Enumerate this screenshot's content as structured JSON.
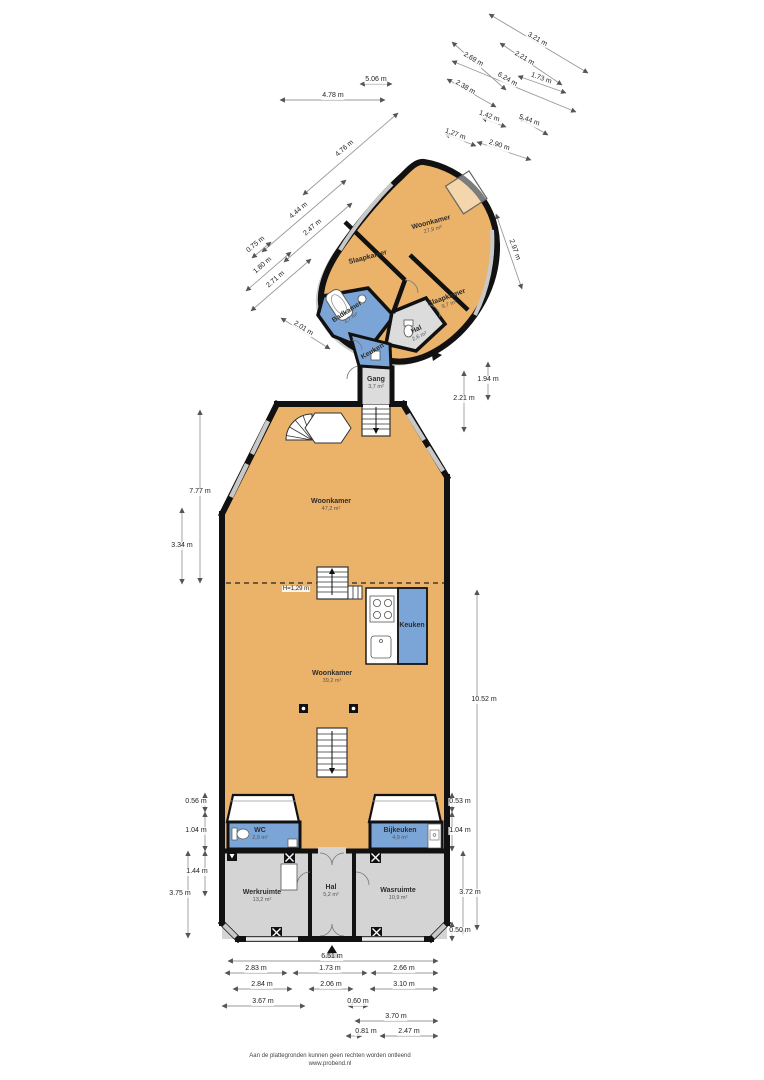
{
  "title": "Floor plan",
  "colors": {
    "room_orange": "#EBB269",
    "room_blue": "#7BA5D6",
    "room_gray": "#D4D4D4",
    "wall_black": "#111111",
    "dimension_gray": "#9A9A9A"
  },
  "top_building": {
    "rooms": {
      "woonkamer": {
        "name": "Woonkamer",
        "area": "27,9 m²"
      },
      "slaapkamer_left": {
        "name": "Slaapkamer"
      },
      "slaapkamer_right": {
        "name": "Slaapkamer",
        "area": "9,7 m²"
      },
      "badkamer": {
        "name": "Badkamer",
        "area": "3,7 m²"
      },
      "hal": {
        "name": "Hal",
        "area": "2,6 m²"
      },
      "keuken": {
        "name": "Keuken"
      }
    }
  },
  "connector": {
    "gang": {
      "name": "Gang",
      "area": "3,7 m²"
    }
  },
  "main_building": {
    "rooms": {
      "woonkamer_top": {
        "name": "Woonkamer",
        "area": "47,2 m²"
      },
      "woonkamer_mid": {
        "name": "Woonkamer",
        "area": "39,2 m²"
      },
      "keuken": {
        "name": "Keuken"
      },
      "wc": {
        "name": "WC",
        "area": "2,9 m²"
      },
      "bijkeuken": {
        "name": "Bijkeuken",
        "area": "4,9 m²"
      },
      "werkruimte": {
        "name": "Werkruimte",
        "area": "13,2 m²"
      },
      "hal": {
        "name": "Hal",
        "area": "5,2 m²"
      },
      "wasruimte": {
        "name": "Wasruimte",
        "area": "10,9 m²"
      }
    },
    "notes": {
      "height_line": "H=1,29 m"
    }
  },
  "dims": [
    "3.21 m",
    "2.21 m",
    "2.69 m",
    "6.24 m",
    "1.73 m",
    "2.38 m",
    "1.42 m",
    "5.44 m",
    "1.27 m",
    "2.90 m",
    "5.06 m",
    "4.78 m",
    "4.76 m",
    "4.44 m",
    "2.47 m",
    "0.75 m",
    "1.80 m",
    "2.71 m",
    "2.01 m",
    "2.97 m",
    "2.21 m",
    "1.94 m",
    "7.77 m",
    "3.34 m",
    "0.56 m",
    "1.04 m",
    "1.44 m",
    "3.75 m",
    "10.52 m",
    "0.53 m",
    "1.04 m",
    "3.72 m",
    "0.50 m",
    "6.51 m",
    "2.83 m",
    "1.73 m",
    "2.66 m",
    "2.84 m",
    "2.06 m",
    "3.10 m",
    "3.67 m",
    "0.60 m",
    "3.70 m",
    "0.81 m",
    "2.47 m"
  ],
  "footer": {
    "disclaimer_line1": "Aan de plattegronden kunnen geen rechten worden ontleend",
    "disclaimer_line2": "www.probend.nl"
  }
}
